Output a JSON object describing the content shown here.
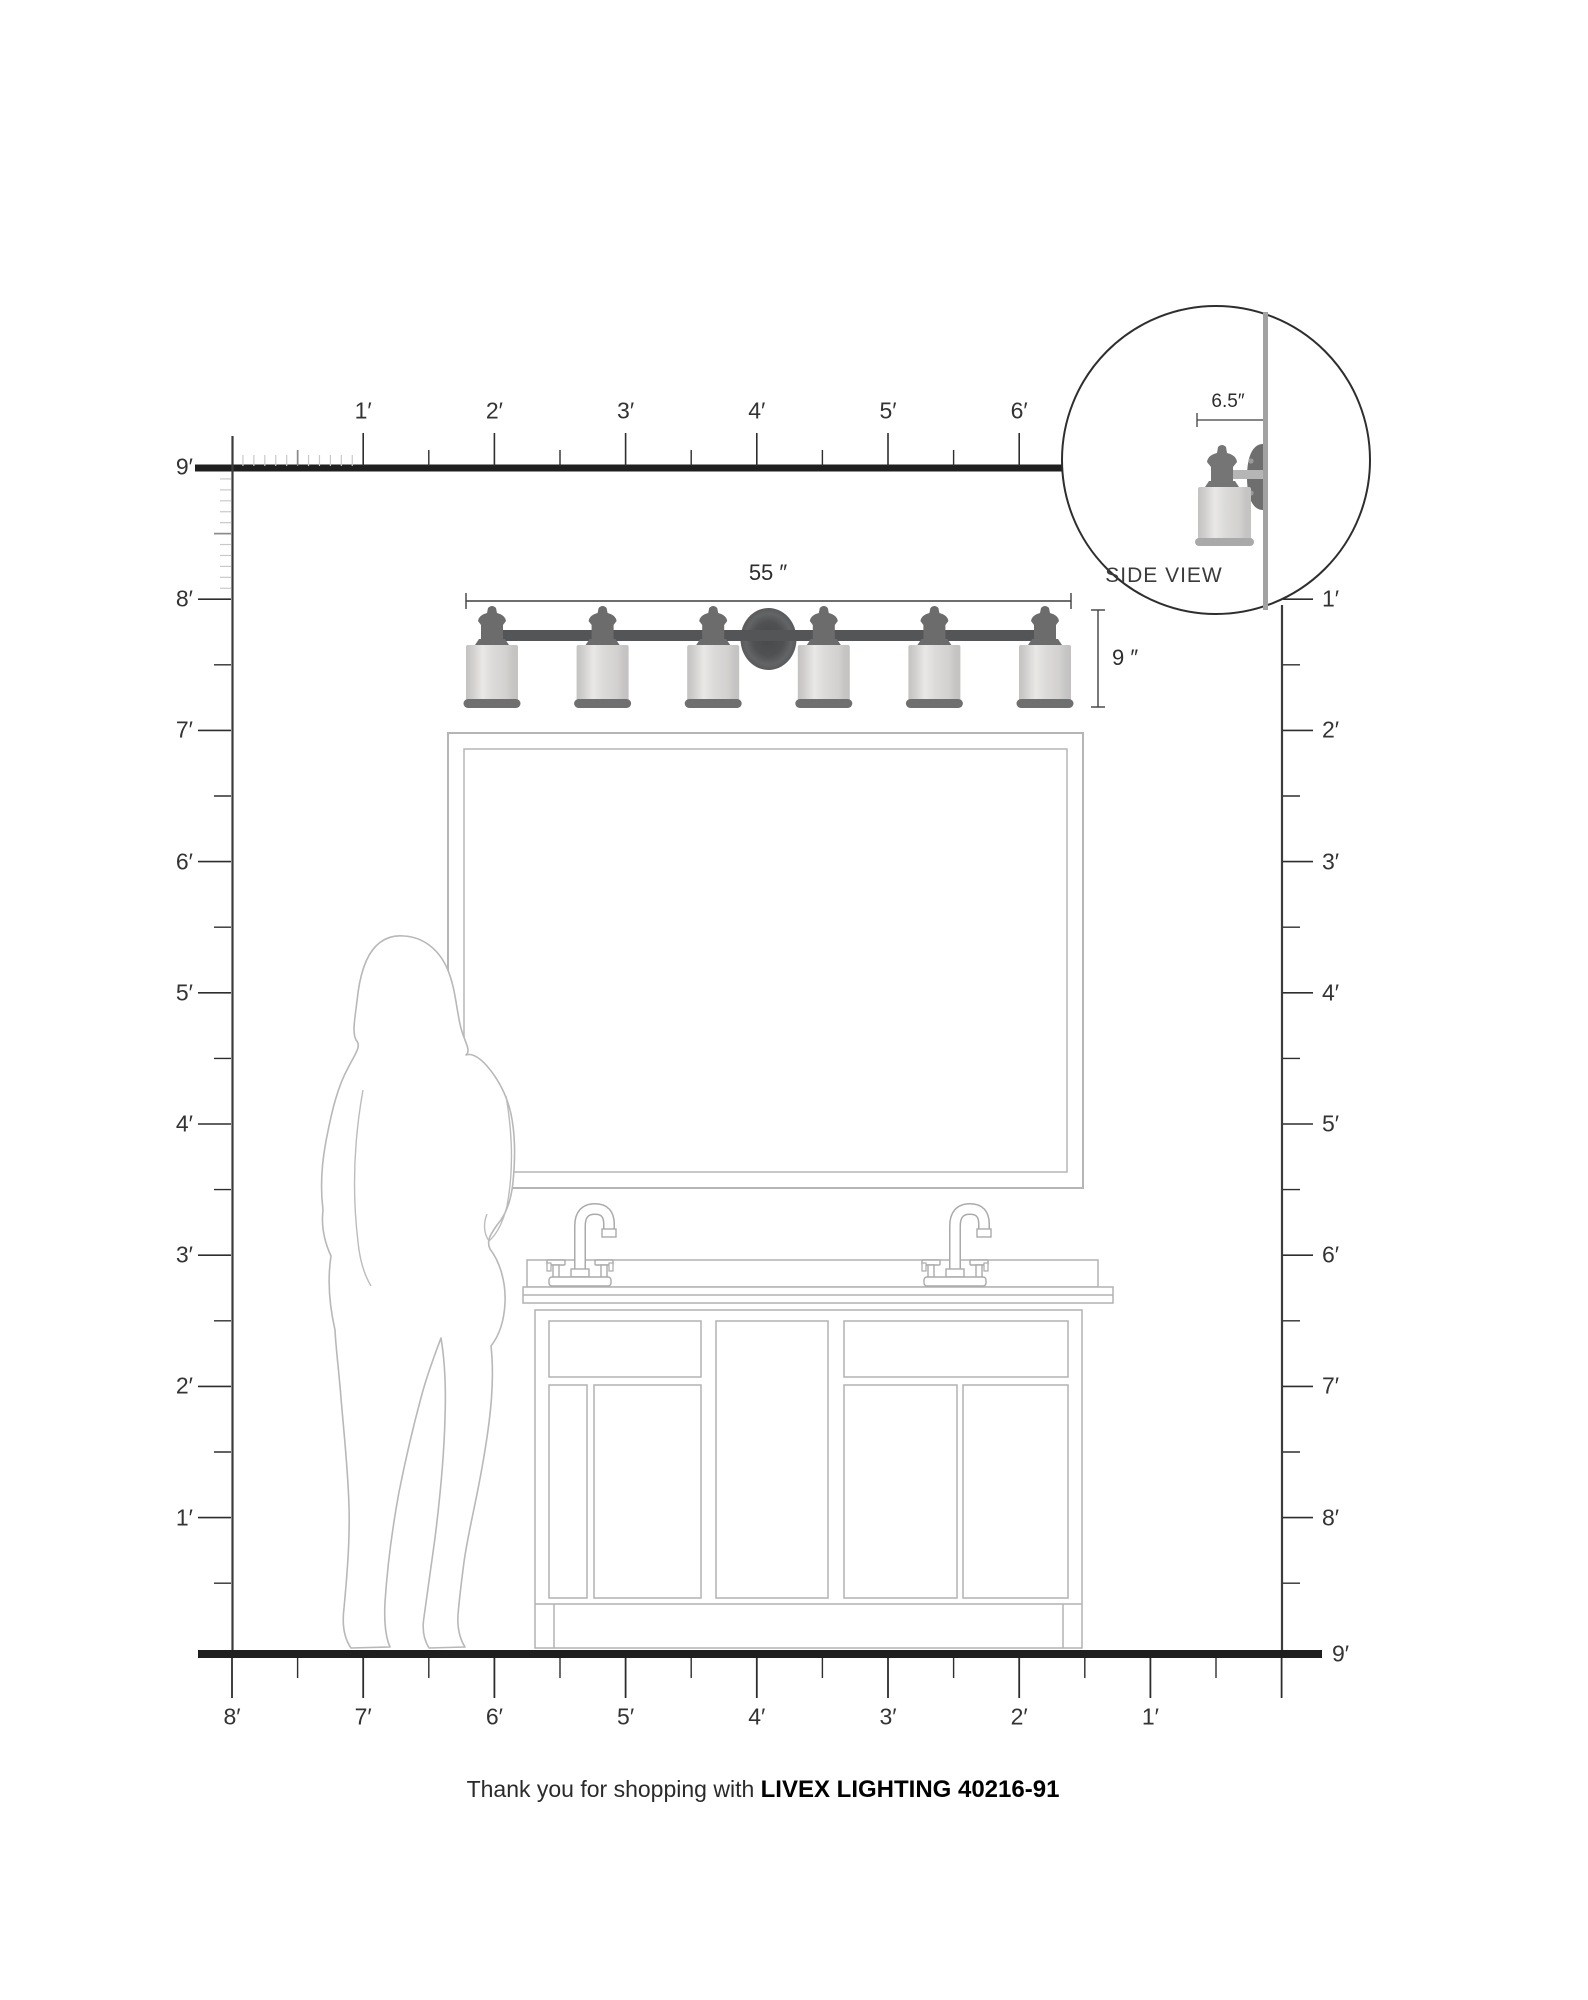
{
  "title": "Livex Lighting fixture scale diagram",
  "rulers": {
    "top": {
      "labels": [
        "1′",
        "2′",
        "3′",
        "4′",
        "5′",
        "6′"
      ]
    },
    "left": {
      "nine_label": "9′",
      "labels": [
        "8′",
        "7′",
        "6′",
        "5′",
        "4′",
        "3′",
        "2′",
        "1′"
      ]
    },
    "right": {
      "labels": [
        "1′",
        "2′",
        "3′",
        "4′",
        "5′",
        "6′",
        "7′",
        "8′"
      ],
      "nine_label": "9′"
    },
    "bottom": {
      "labels": [
        "8′",
        "7′",
        "6′",
        "5′",
        "4′",
        "3′",
        "2′",
        "1′"
      ]
    }
  },
  "dimensions": {
    "fixture_width": "55 ″",
    "fixture_height": "9 ″",
    "fixture_depth": "6.5″"
  },
  "side_view": {
    "title": "SIDE VIEW"
  },
  "footer": {
    "prefix": "Thank you for shopping with ",
    "brand": "LIVEX LIGHTING 40216-91"
  },
  "colors": {
    "heavy_line": "#1f1f1f",
    "ruler_text": "#333333",
    "tick": "#2e2e2e",
    "inch_tick": "#c9c9c9",
    "outline_gray": "#b2b2b2",
    "metal_dark": "#6c6c6c",
    "bar": "#545557",
    "shade_light": "#e7e6e5",
    "shade_edge": "#c3c2c1",
    "wall_gray": "#a2a2a2"
  }
}
